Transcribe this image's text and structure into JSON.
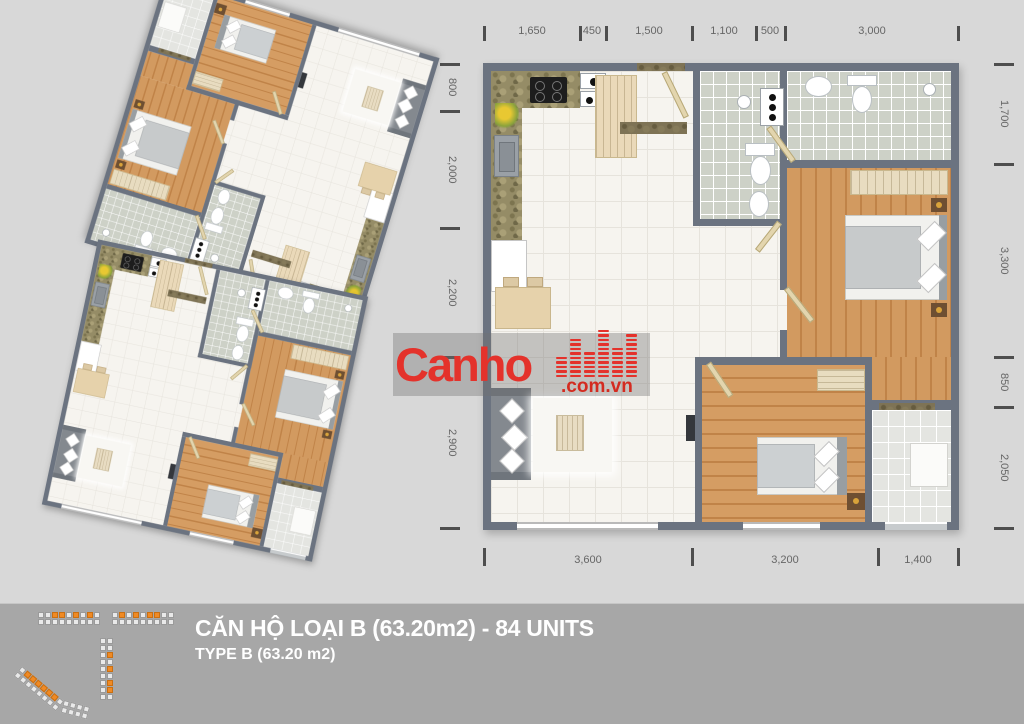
{
  "title": {
    "line1": "CĂN HỘ LOẠI B (63.20m2) - 84 UNITS",
    "line2": "TYPE B (63.20 m2)"
  },
  "logo": {
    "name": "Canho",
    "suffix": ".com.vn"
  },
  "dimensions": {
    "top": [
      "1,650",
      "450",
      "1,500",
      "1,100",
      "500",
      "3,000"
    ],
    "bottom": [
      "3,600",
      "3,200",
      "1,400"
    ],
    "left": [
      "800",
      "2,000",
      "2,200",
      "2,900"
    ],
    "right": [
      "1,700",
      "3,300",
      "850",
      "2,050"
    ]
  },
  "colors": {
    "background": "#d8d8d8",
    "band": "#a7a7a7",
    "wall": "#6b7380",
    "wood": "#d29a60",
    "bath_tile": "#cdd1c7",
    "accent_red": "#e4322b",
    "legend_orange": "#f08a24"
  },
  "legend": {
    "blocks": [
      {
        "cols": 9,
        "rows": 2,
        "orange": [
          2,
          3,
          5,
          7
        ]
      },
      {
        "cols": 9,
        "rows": 2,
        "orange": [
          1,
          3,
          5,
          6
        ]
      },
      {
        "cols": 2,
        "rows": 9,
        "orange": [
          5,
          9,
          13,
          15
        ]
      },
      {
        "cols": 8,
        "rows": 2,
        "orange": [
          1,
          2,
          3,
          4,
          5,
          6
        ]
      },
      {
        "cols": 4,
        "rows": 2,
        "orange": []
      }
    ]
  }
}
